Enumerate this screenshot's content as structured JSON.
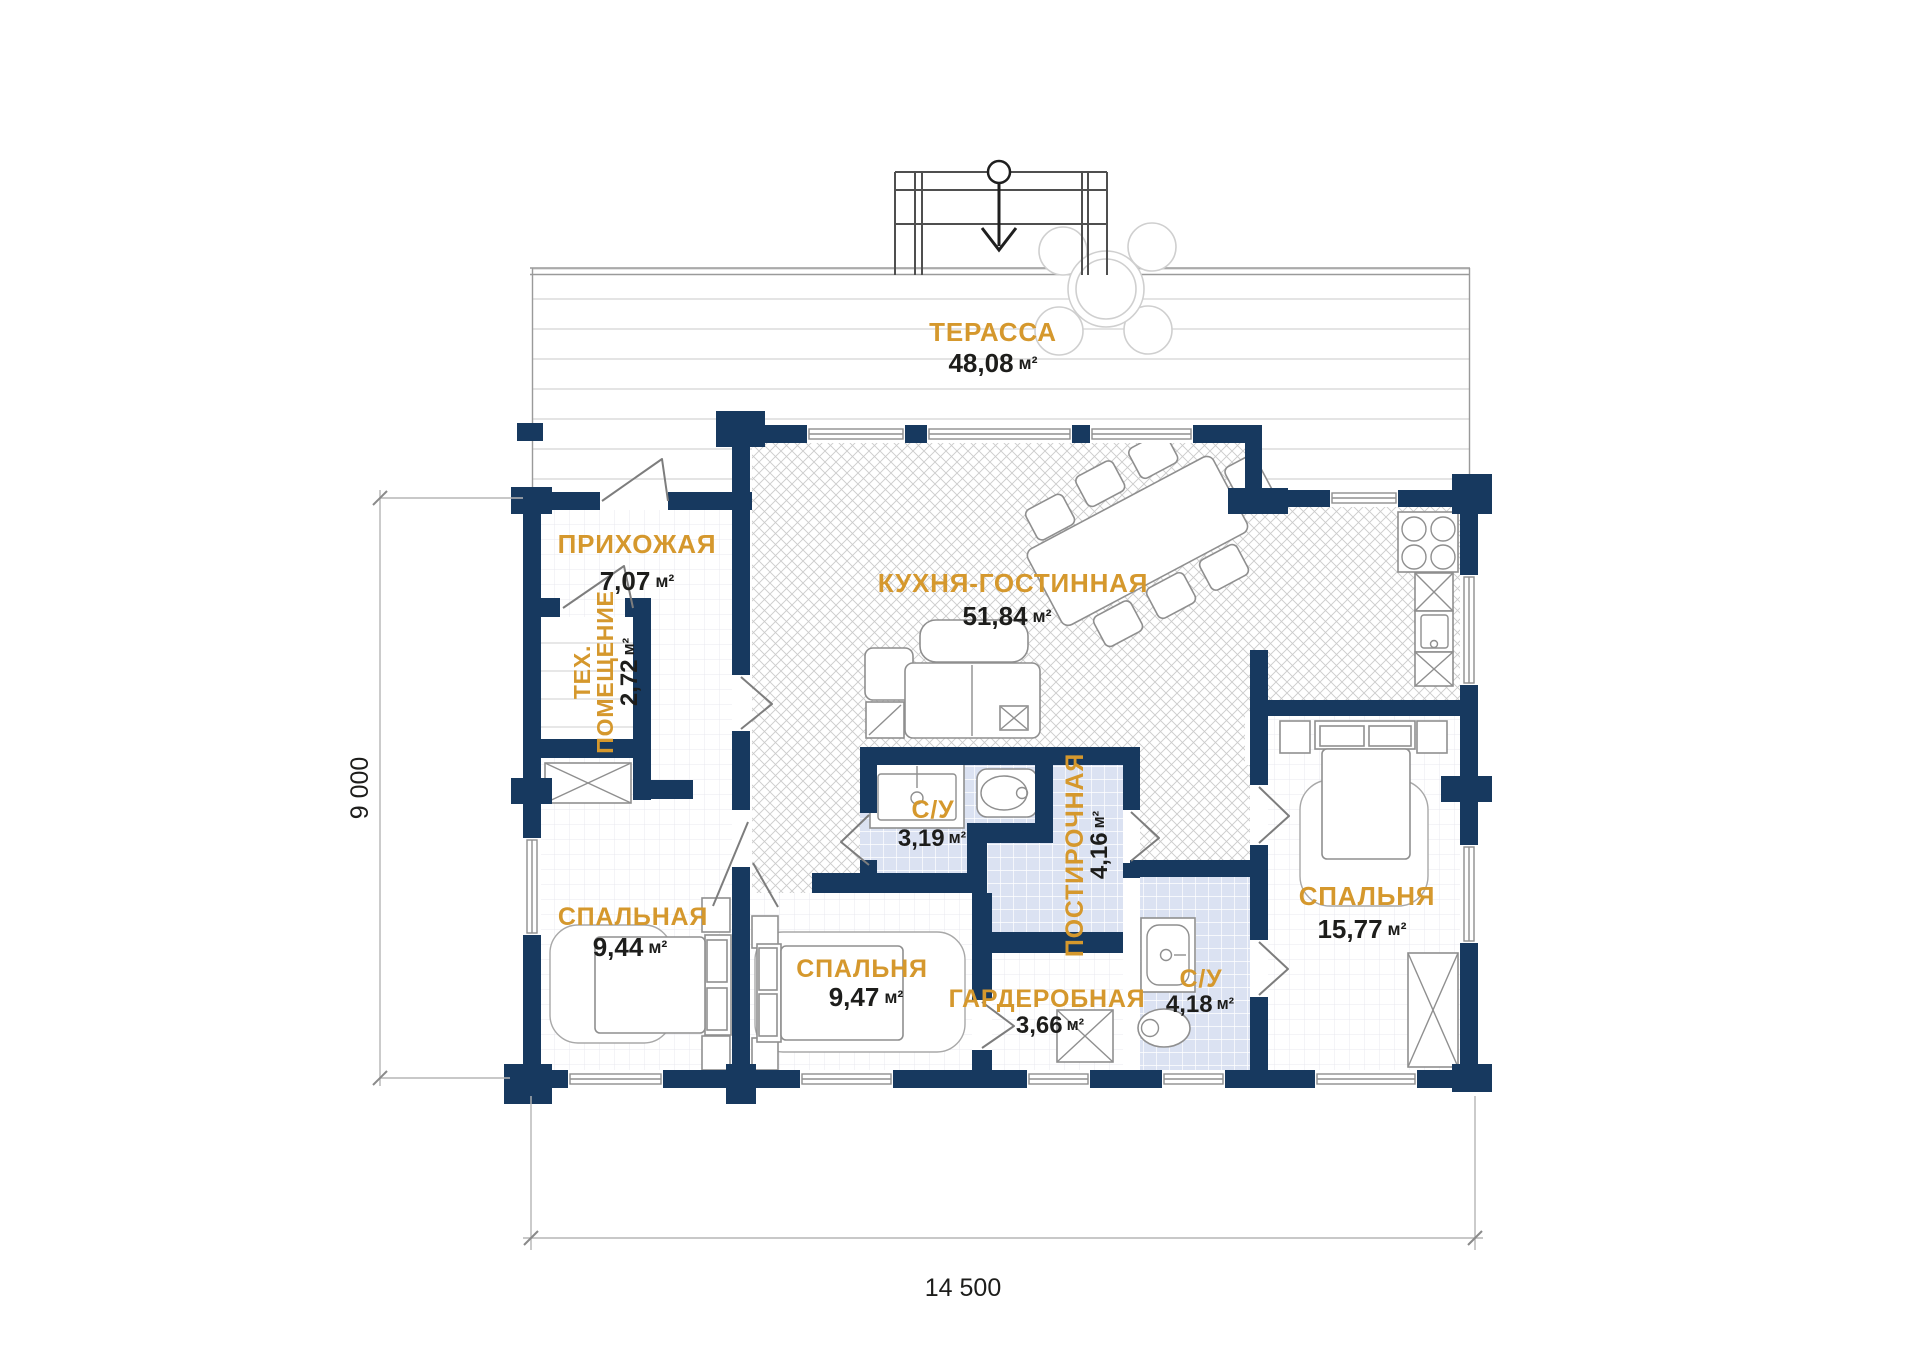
{
  "unit": "м²",
  "rooms": [
    {
      "id": "terrace",
      "name": "ТЕРАССА",
      "area": "48,08"
    },
    {
      "id": "hallway",
      "name": "ПРИХОЖАЯ",
      "area": "7,07"
    },
    {
      "id": "tech-room",
      "name_lines": [
        "ТЕХ.",
        "ПОМЕЩЕНИЕ"
      ],
      "area": "2,72"
    },
    {
      "id": "kitchen-living",
      "name": "КУХНЯ-ГОСТИННАЯ",
      "area": "51,84"
    },
    {
      "id": "bathroom-1",
      "name": "С/У",
      "area": "3,19"
    },
    {
      "id": "laundry",
      "name": "ПОСТИРОЧНАЯ",
      "area": "4,16"
    },
    {
      "id": "bedroom-master",
      "name": "СПАЛЬНЯ",
      "area": "15,77"
    },
    {
      "id": "bedroom-2",
      "name": "СПАЛЬНАЯ",
      "area": "9,44"
    },
    {
      "id": "bedroom-3",
      "name": "СПАЛЬНЯ",
      "area": "9,47"
    },
    {
      "id": "wardrobe-room",
      "name": "ГАРДЕРОБНАЯ",
      "area": "3,66"
    },
    {
      "id": "bathroom-2",
      "name": "С/У",
      "area": "4,18"
    }
  ],
  "dimensions": {
    "overall_width": "14 500",
    "overall_height": "9 000"
  },
  "colors": {
    "wall": "#17395F",
    "label": "#D5982D",
    "text": "#1D1D1B"
  }
}
